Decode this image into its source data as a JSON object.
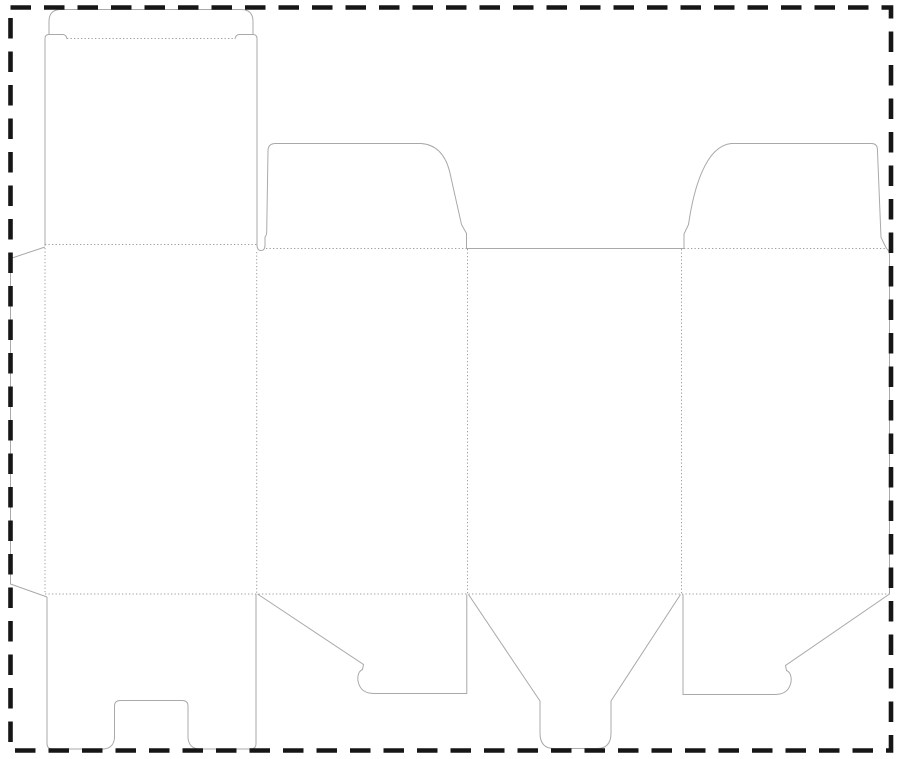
{
  "diagram": {
    "kind": "packaging-dieline",
    "description": "Die-cut template (dieline) of a folding carton: glue flap, four body panels, tuck-top lid with dust flaps, snap-lock bottom flaps and center tongue. Solid grey lines are cut lines, dotted grey lines are fold/crease lines, thick black dashed rectangle is the sheet boundary.",
    "canvas": {
      "width": 900,
      "height": 759,
      "background": "#ffffff"
    },
    "styles": {
      "cut_line": {
        "color": "#a9a9a9",
        "width": 1
      },
      "fold_line": {
        "color": "#9e9e9e",
        "width": 1,
        "dash": "1.3 2.2"
      },
      "boundary": {
        "color": "#161616",
        "width": 4.6,
        "dash": "20.5 13"
      }
    },
    "boundary": {
      "x": 10.5,
      "y": 7.5,
      "width": 880.5,
      "height": 743
    },
    "cut_paths": [
      {
        "name": "glue-flap-edge",
        "d": "M45,247 L10.5,258.5 L10.5,584 L47,597"
      },
      {
        "name": "tuck-flap-outline",
        "d": "M45,244.5 L45,38.5 Q45,34.5 49,34.5 L49,21.5 Q49,9.5 61,9.5 L241,9.5 Q253,9.5 253,21.5 L253,34.5 Q257,34.5 257,38.5"
      },
      {
        "name": "tuck-shoulder-hooks",
        "d": "M49,34.5 L63,34.5 Q66.5,35 67,39 M253,34.5 L239,34.5 Q235.5,35 235,39"
      },
      {
        "name": "panel1-right-edge-slot-and-top-dust-flap-left",
        "d": "M257,38.5 L257,245 Q257,250.5 261,250.5 Q265,250.5 265,245 L265,237 Q266.5,235.5 266.7,232 L268,151 Q268,143.5 275.5,143.5 L421,143.5 C436,144.5 445,154 449.5,171 L461.5,224.5 L466.5,233.5 L466.5,248.5"
      },
      {
        "name": "panel3-top-cut-edge",
        "d": "M466.5,248.5 L684,248.5"
      },
      {
        "name": "top-dust-flap-right-outline",
        "d": "M684,248.5 L684,234 L688.5,224.5 C693.5,190 705,146.5 731,143.5 L871.5,143.5 Q877,143.5 877.4,149 L881,237.5 L886.5,248.5"
      },
      {
        "name": "panel4-right-edge-and-bottom-flap-right",
        "d": "M886.5,248.5 Q889.5,250.5 889.5,256 L889.5,594 L785.5,665.5 L786.5,670.5 C791.5,672.5 793,681 788.5,688.5 C785.5,693 781,694.5 774.5,694.5 L683,694.5 L683,594.5"
      },
      {
        "name": "bottom-flap-left-outline",
        "d": "M257.5,594 L363.5,664.5 L362.5,669.5 C357.5,671.5 356,680 360.5,687.5 C363.5,692 368,693.5 374.5,693.5 L466.8,693.5 L466.8,594.5"
      },
      {
        "name": "bottom-lock-tongue-outline",
        "d": "M468.5,594.5 L540,701 L540,733 Q540,748.5 554,748.5 L597,748.5 Q611,748.5 611,733 L611,701 L680.5,594.5"
      },
      {
        "name": "bottom-panel-with-notch-outline",
        "d": "M47,597 L47,743.5 Q47,749 52.5,749 L104,749 Q113.5,748 114.5,738 L114.5,706 Q114.5,700.5 120.5,700.5 L182,700.5 Q188,700.5 188,706 L188,738 Q189,748 198.5,749 L250.5,749 Q256,749 256,743.5 L256,594.5"
      }
    ],
    "fold_paths": [
      {
        "name": "tuck-flap-crease",
        "d": "M67,38.5 L235,38.5"
      },
      {
        "name": "panel1-top-crease",
        "d": "M45,244.5 L257,244.5"
      },
      {
        "name": "dust-flap-left-crease",
        "d": "M266,248.5 L466.5,248.5"
      },
      {
        "name": "dust-flap-right-crease",
        "d": "M684,248.5 L886.5,248.5"
      },
      {
        "name": "glue-flap-crease",
        "d": "M45,244.5 L45,594"
      },
      {
        "name": "panel1-panel2-crease",
        "d": "M256.7,252 L256.7,594"
      },
      {
        "name": "panel2-panel3-crease",
        "d": "M467.5,249 L467.5,594"
      },
      {
        "name": "panel3-panel4-crease",
        "d": "M681.5,249 L681.5,594"
      },
      {
        "name": "bottom-crease",
        "d": "M45,594 L889.5,594"
      }
    ]
  }
}
